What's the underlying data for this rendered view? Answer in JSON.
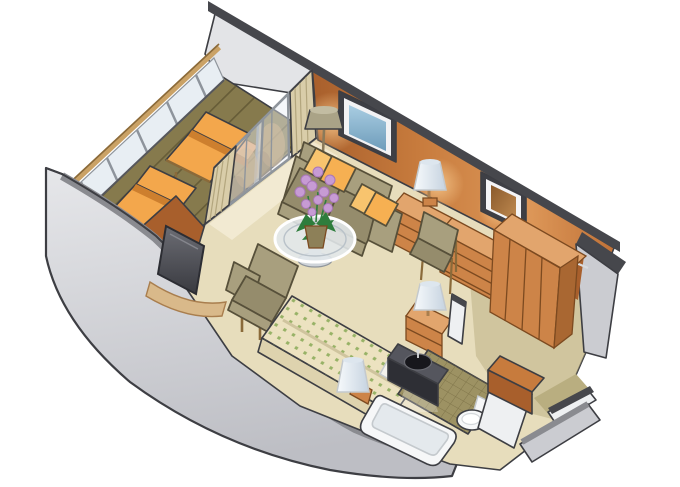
{
  "illustration": {
    "kind": "isometric cutaway floor plan of a ship stateroom with private balcony",
    "rooms": [
      "balcony",
      "living-sleeping area",
      "bathroom",
      "entry"
    ]
  },
  "colors": {
    "bg": "#ffffff",
    "outline": "#3d3e43",
    "cap": "#46474c",
    "cap_mid": "#8a8b90",
    "wall_gray_light": "#e3e4e7",
    "wall_gray": "#cbccd1",
    "wall_gray_dark": "#b0b1b7",
    "wall_orange": "#c77b3d",
    "wall_orange_light": "#e09a62",
    "wall_orange_dark": "#a85f2c",
    "carpet": "#e7ddbc",
    "carpet_light": "#f3ecd6",
    "carpet_dark": "#b9ae80",
    "deck": "#867a4d",
    "deck_line": "#675d38",
    "lounger": "#f3a74c",
    "lounger_dark": "#cd7f2e",
    "handrail": "#d2a868",
    "handrail_dark": "#8a6a3a",
    "glass": "#e8eef3",
    "glass_frame": "#8f959c",
    "curtain": "#d9cda9",
    "curtain_line": "#b3a67e",
    "sofa": "#a89f7e",
    "sofa_dark": "#958c6c",
    "sofa_outline": "#57503a",
    "pillow": "#f6b052",
    "pillow_light": "#f8c46e",
    "wood": "#cd8448",
    "wood_light": "#e2a56d",
    "wood_dark": "#a96732",
    "wood_line": "#7c4a20",
    "lamp_shade": "#eef2f7",
    "lamp_shade_dark": "#c6d3e0",
    "lamp_olive": "#aaa387",
    "screen_blue": "#9cc3da",
    "screen_blue_dark": "#6e9cba",
    "mirror_brown": "#a06830",
    "tv": "#5f6067",
    "tv_dark": "#393a40",
    "plant_leaf": "#2e7d3c",
    "plant_flower": "#c79bd4",
    "plant_flower_dark": "#a976b8",
    "pot": "#8d8058",
    "spread": "#ece2c0",
    "spread_dot": "#97b266",
    "spread_side": "#ded3ae",
    "linen": "#f4f2ec",
    "tile": "#9d9263",
    "tile_line": "#80754a",
    "fixture": "#f6f7f8",
    "fixture_shadow": "#c4c9cd",
    "vanity": "#55565e",
    "vanity_dark": "#2e2f35",
    "basin": "#17171c",
    "white_wall": "#eef0f2"
  }
}
